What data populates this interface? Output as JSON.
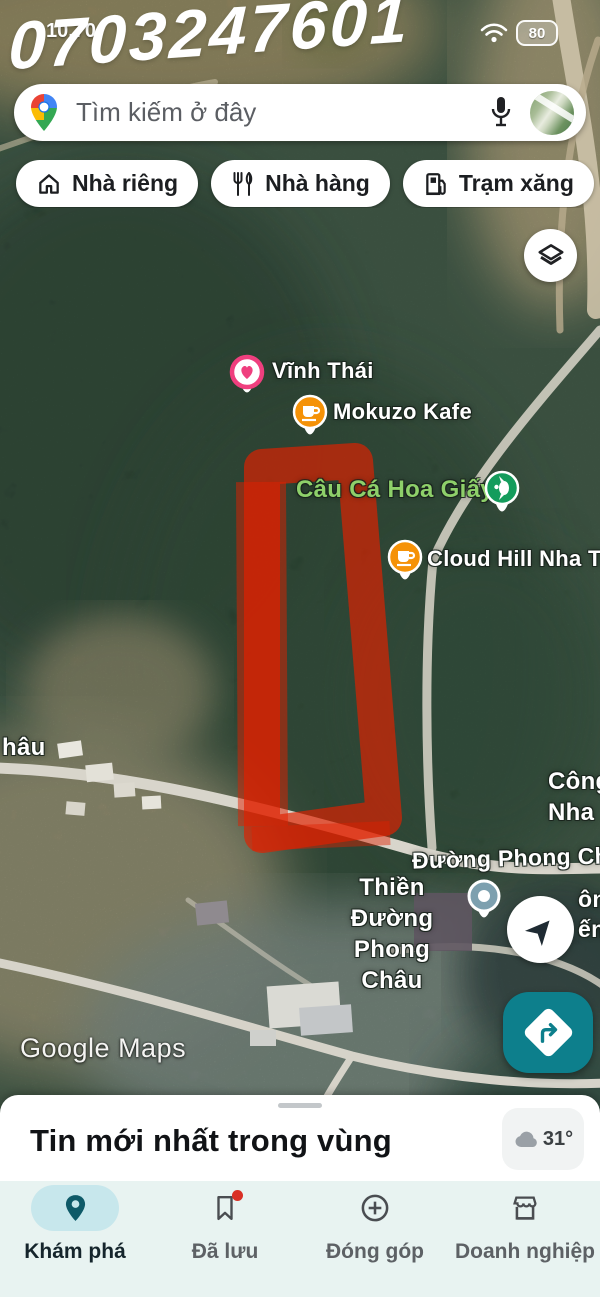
{
  "status_bar": {
    "time": "10.70",
    "battery_percent": "80"
  },
  "watermark_phone": "0703247601",
  "search_bar": {
    "placeholder": "Tìm kiếm ở đây"
  },
  "chips": [
    {
      "label": "Nhà riêng",
      "icon": "home-icon"
    },
    {
      "label": "Nhà hàng",
      "icon": "restaurant-icon"
    },
    {
      "label": "Trạm xăng",
      "icon": "gas-station-icon"
    },
    {
      "label": "Q",
      "icon": "cafe-icon"
    }
  ],
  "map": {
    "pois": [
      {
        "label": "Vĩnh Thái",
        "pin": "heart-pin",
        "pin_color": "#ef3f7e"
      },
      {
        "label": "Mokuzo Kafe",
        "pin": "cafe-pin",
        "pin_color": "#f59207"
      },
      {
        "label": "Câu Cá Hoa Giấy",
        "pin": "fishing-pin",
        "pin_color": "#149c5c",
        "label_color": "#8ed06a"
      },
      {
        "label": "Cloud Hill Nha Tra",
        "pin": "cafe-pin",
        "pin_color": "#f59207"
      },
      {
        "label_line1": "Thiền Đường",
        "label_line2": "Phong Châu",
        "pin": "dot-pin",
        "pin_color": "#7da0af"
      }
    ],
    "road_label": "Đường Phong Ch",
    "edge_label_left": "hâu",
    "edge_label_right_line1": "Công",
    "edge_label_right_line2": "Nha",
    "edge_fragment_line1": "ôn",
    "edge_fragment_line2": "ến",
    "attribution": "Google Maps",
    "highlight_color": "#e02000"
  },
  "bottom_sheet": {
    "title": "Tin mới nhất trong vùng",
    "temperature": "31°"
  },
  "bottom_nav": {
    "items": [
      {
        "label": "Khám phá",
        "active": true
      },
      {
        "label": "Đã lưu",
        "has_badge": true
      },
      {
        "label": "Đóng góp"
      },
      {
        "label": "Doanh nghiệp"
      }
    ]
  },
  "colors": {
    "accent_teal": "#0d7f8c",
    "nav_background": "#e8f3f1",
    "active_pill": "#c7e7ec",
    "highlight_red": "#e02000",
    "poi_orange": "#f59207",
    "poi_green": "#149c5c",
    "poi_pink": "#ef3f7e"
  }
}
